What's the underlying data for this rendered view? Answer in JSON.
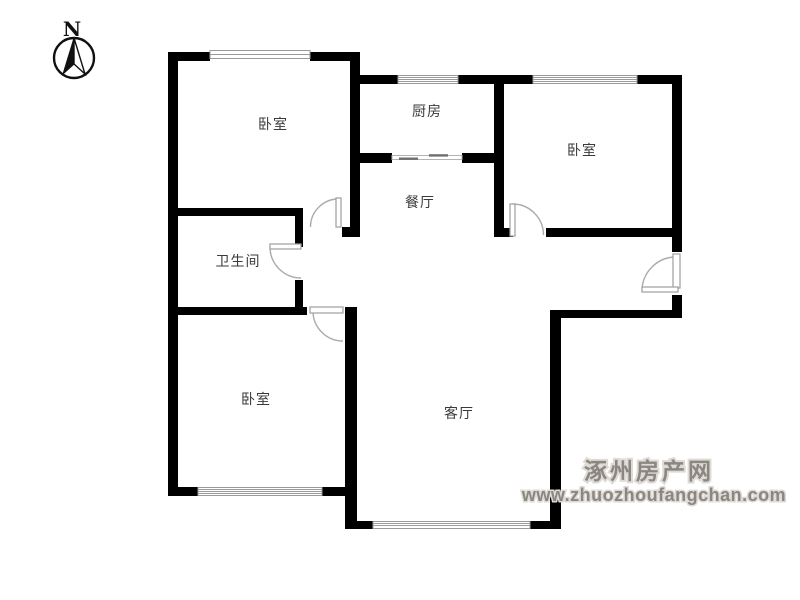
{
  "compass": {
    "label": "N"
  },
  "rooms": [
    {
      "id": "bedroom-top-left",
      "label": "卧室"
    },
    {
      "id": "kitchen",
      "label": "厨房"
    },
    {
      "id": "bedroom-top-right",
      "label": "卧室"
    },
    {
      "id": "dining-room",
      "label": "餐厅"
    },
    {
      "id": "bathroom",
      "label": "卫生间"
    },
    {
      "id": "bedroom-bottom-left",
      "label": "卧室"
    },
    {
      "id": "living-room",
      "label": "客厅"
    }
  ],
  "watermark": {
    "site_name": "涿州房产网",
    "site_url": "www.zhuozhoufangchan.com",
    "color": "#8b8680"
  },
  "colors": {
    "wall": "#000000",
    "door_arc": "#ababab",
    "window_frame": "#9a9a9a",
    "label_text": "#3a3a3a",
    "background": "#ffffff"
  }
}
